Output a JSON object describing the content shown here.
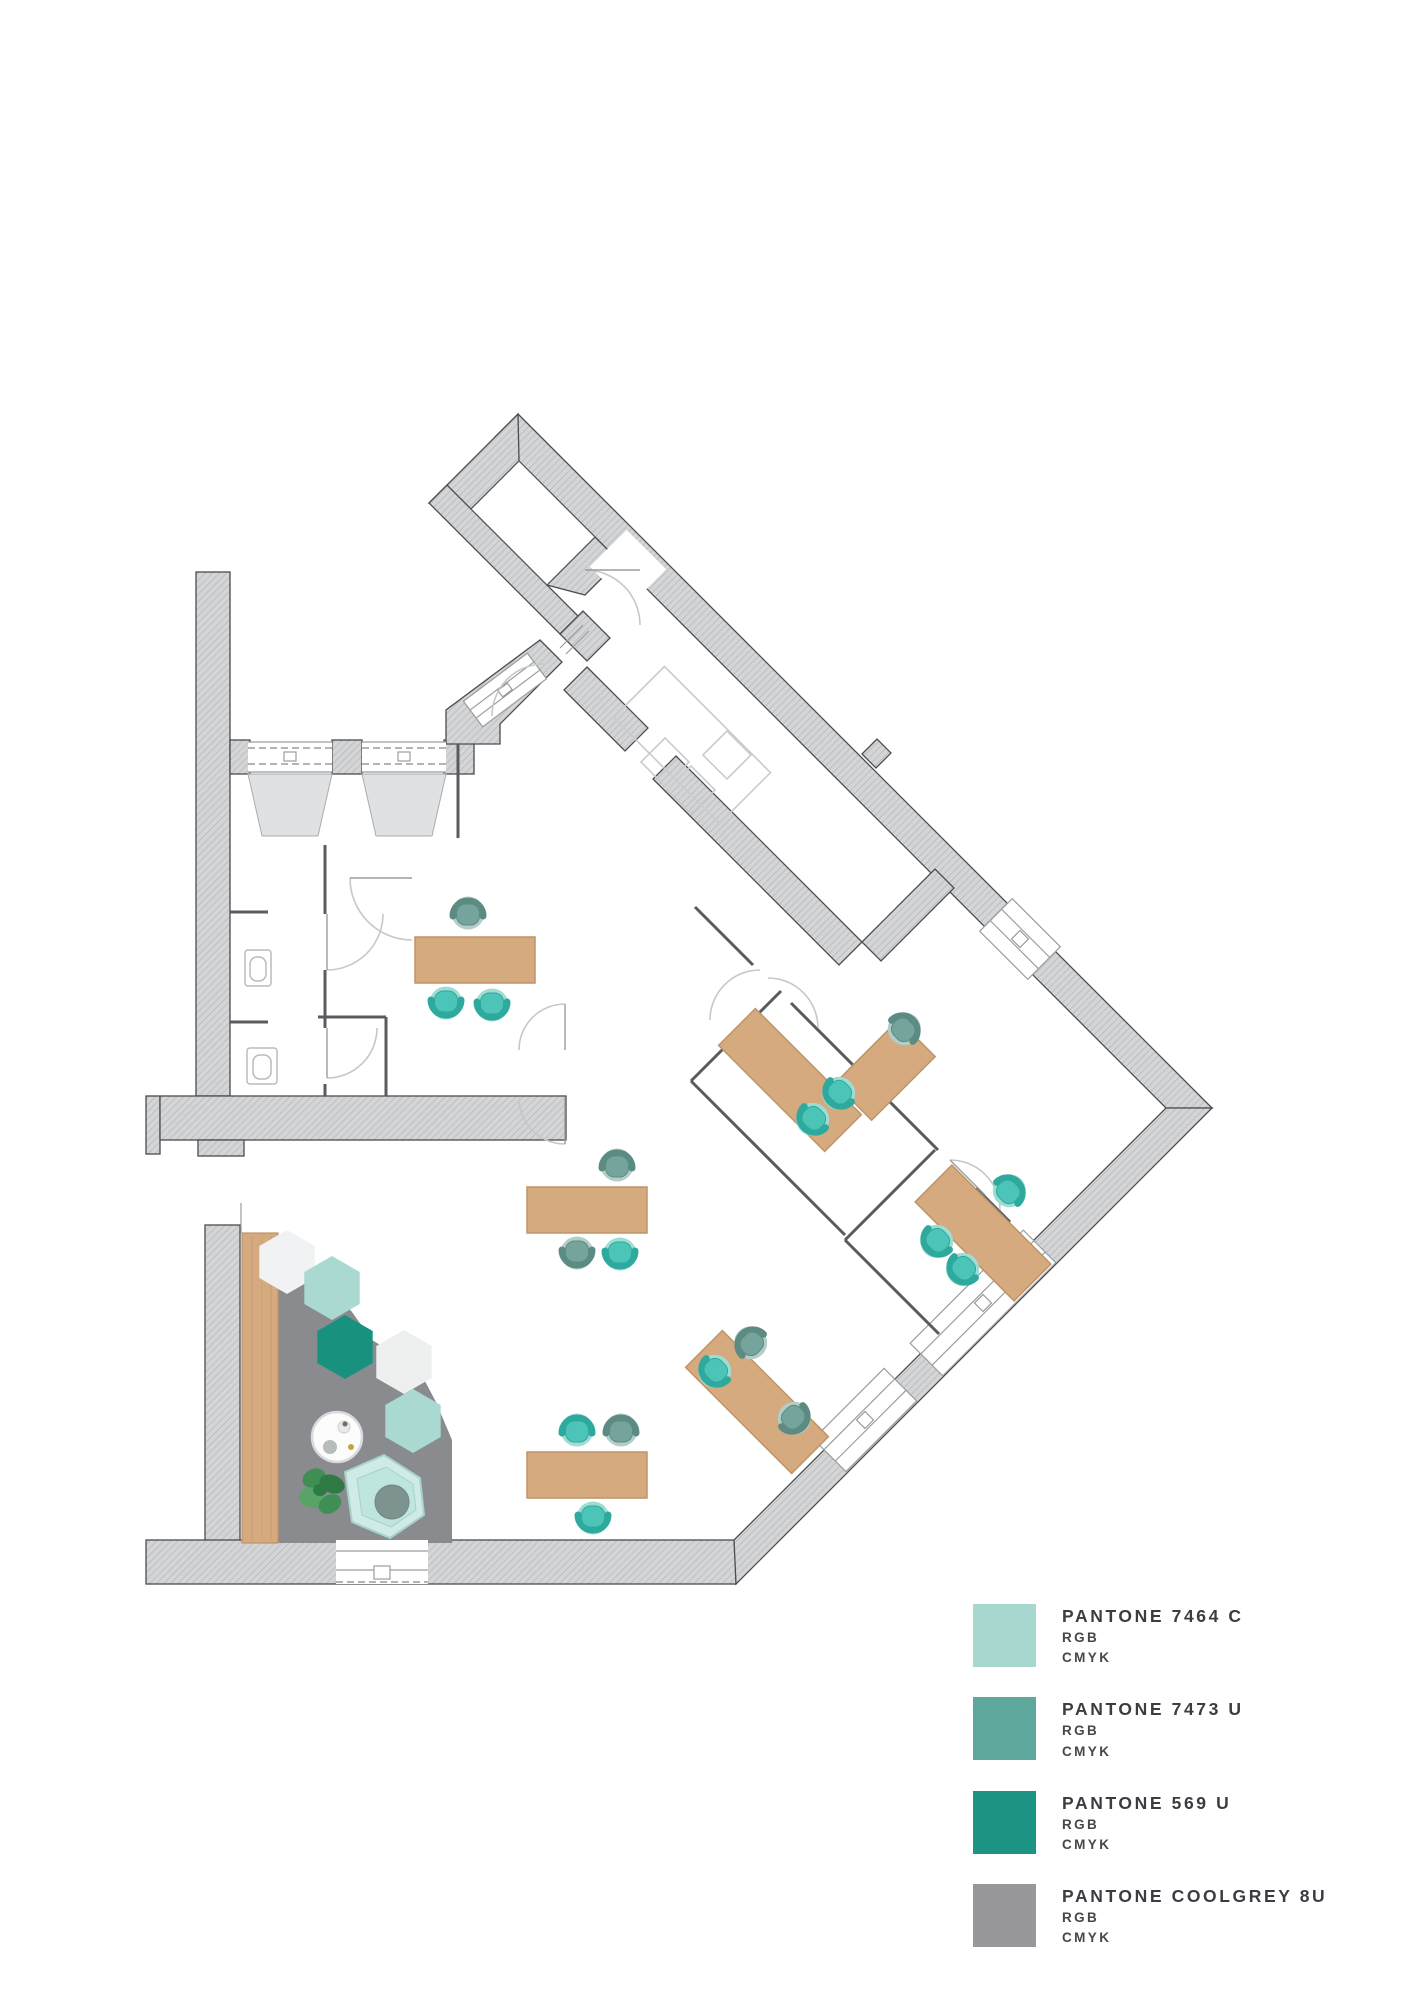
{
  "legend": {
    "items": [
      {
        "pantone": "PANTONE 7464 C",
        "rgb_label": "RGB",
        "cmyk_label": "CMYK",
        "color": "#a7d7ce"
      },
      {
        "pantone": "PANTONE 7473 U",
        "rgb_label": "RGB",
        "cmyk_label": "CMYK",
        "color": "#5fa89d"
      },
      {
        "pantone": "PANTONE 569 U",
        "rgb_label": "RGB",
        "cmyk_label": "CMYK",
        "color": "#1d9384"
      },
      {
        "pantone": "PANTONE COOLGREY 8U",
        "rgb_label": "RGB",
        "cmyk_label": "CMYK",
        "color": "#98979b"
      }
    ]
  },
  "palette": {
    "wall_fill": "#d3d5d6",
    "wall_hatch": "#b7b9bb",
    "wall_outline": "#4b4c50",
    "thin_wall": "#595b5f",
    "faint_line": "#c9cbcd",
    "door_arc": "#c5c7c9",
    "wood": "#d4aa7e",
    "wood_edge": "#bf9468",
    "teal_bright_seat": "#4cc4b8",
    "teal_bright_back": "#2ea99d",
    "teal_bright_rim": "#9edcd4",
    "teal_muted_seat": "#74a49c",
    "teal_muted_back": "#5c8b84",
    "teal_muted_rim": "#b3cdc7",
    "lounge_floor": "#8a8b8f",
    "hex_white": "#f1f2f3",
    "hex_light": "#a9d9d0",
    "hex_dark": "#18917f",
    "hex_pale": "#eef0f0",
    "armchair": "#cfeae7",
    "armchair_seat": "#bfe5df",
    "armchair_shadow": "#a5d2cb",
    "cushion": "#7e938f",
    "plant_dark": "#2e7a45",
    "plant_mid": "#3f8f54",
    "plant_light": "#57a466",
    "table_white": "#fcfcfc",
    "table_ring": "#d8dadb"
  }
}
